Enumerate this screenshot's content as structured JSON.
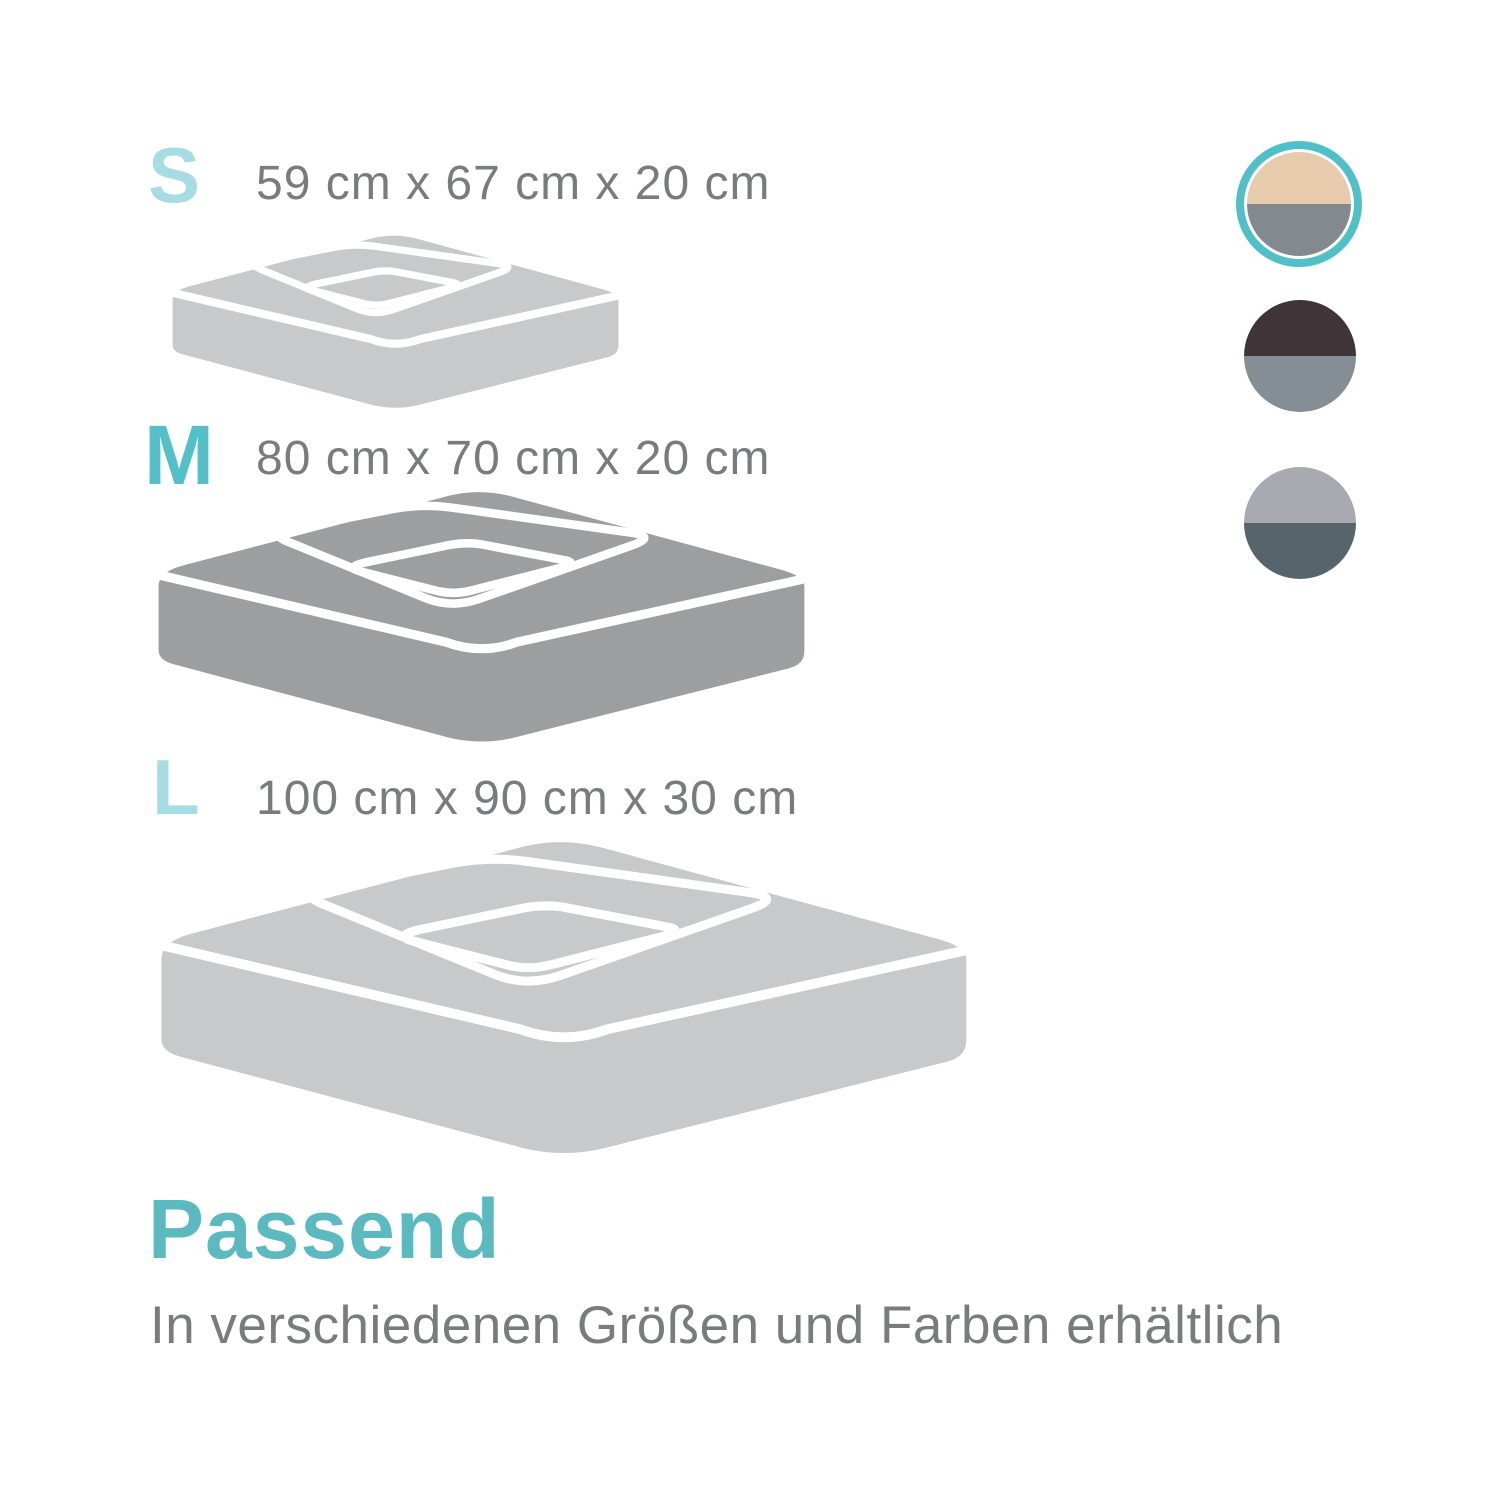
{
  "theme": {
    "background": "#ffffff",
    "text_color": "#7a7b7d",
    "white_line": "#ffffff"
  },
  "sizes": [
    {
      "code": "S",
      "dimensions": "59 cm x 67 cm x 20 cm",
      "label_color": "#a5dde2",
      "bed_color": "#c8c9ca"
    },
    {
      "code": "M",
      "dimensions": "80 cm x 70 cm x 20 cm",
      "label_color": "#53bfc8",
      "bed_color": "#9d9ea0"
    },
    {
      "code": "L",
      "dimensions": "100 cm x 90 cm x 30 cm",
      "label_color": "#a5dde2",
      "bed_color": "#c8c9ca"
    }
  ],
  "color_options": [
    {
      "name": "beige-grey",
      "top": "#e6cbad",
      "bottom": "#82898f",
      "selected": true,
      "ring": "#4fc0c7"
    },
    {
      "name": "dark-brown-grey",
      "top": "#3f3438",
      "bottom": "#868e95",
      "selected": false,
      "ring": ""
    },
    {
      "name": "light-grey-slate",
      "top": "#a9aab1",
      "bottom": "#56646c",
      "selected": false,
      "ring": ""
    }
  ],
  "footer": {
    "heading": "Passend",
    "heading_color": "#5bb9c0",
    "subtitle": "In verschiedenen Größen und Farben erhältlich"
  }
}
